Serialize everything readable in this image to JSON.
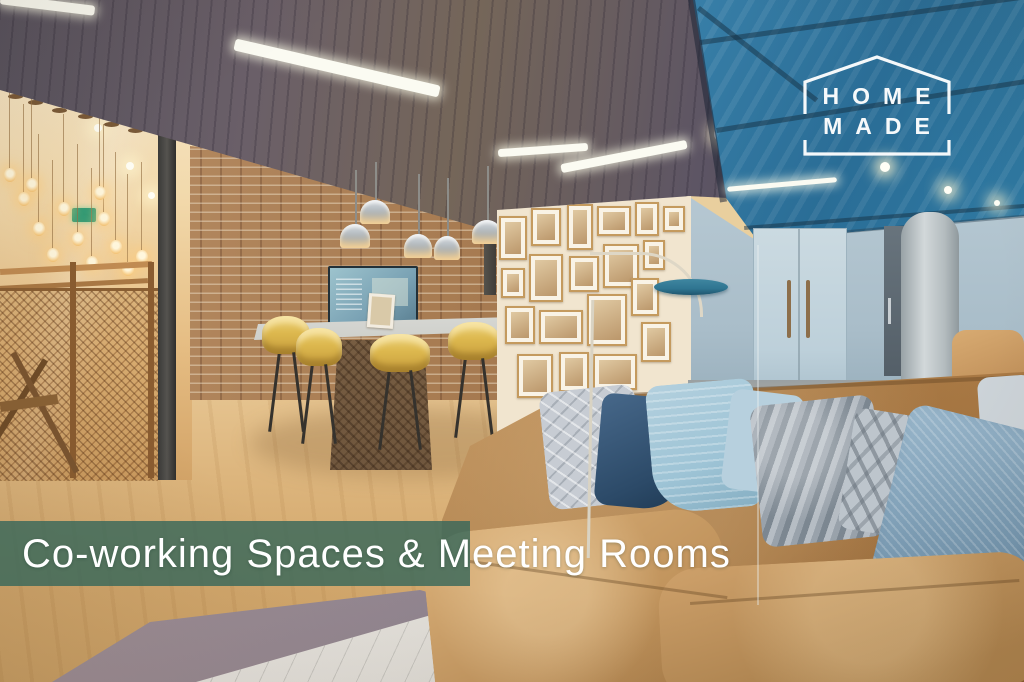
{
  "branding": {
    "logo_line1": "HOME",
    "logo_line2": "MADE",
    "logo_color": "#ffffff"
  },
  "banner": {
    "caption": "Co-working Spaces & Meeting Rooms",
    "text_color": "#ffffff",
    "band_color": "#38685A"
  },
  "scene": {
    "description": "Co-working lounge: vivid blue painted ceiling with dark seams, slate timber ceiling bay, exposed brick wall with wall-mounted TV, white high table with mustard-yellow bar stools, five steel dome pendants, gallery wall of sepia prints in oak frames, pale blue doors and concrete column, teal disc floor lamp, tan suede sofa stacked with blue and grey cushions, pale oak floor, mauve rug with white marble table corner, brass mesh stair screen with festoon bulb chandelier",
    "palette": {
      "ceiling_blue": "#4b94bb",
      "ceiling_dark_bay": "#5e5764",
      "back_ceiling_white": "#f5ead2",
      "brick": "#ab8058",
      "wall_light_blue": "#b7c9d3",
      "door_blue": "#c6d7df",
      "column_grey": "#c2cacc",
      "gallery_wall_cream": "#f1e5cf",
      "frame_oak": "#c49a5e",
      "stool_yellow": "#ddb84e",
      "lamp_teal": "#2f7591",
      "floor_wood": "#dcb57e",
      "rug_mauve": "#9c8e97",
      "marble_white": "#efede8",
      "sofa_tan": "#c3935c",
      "pillow_navy": "#2c4a68",
      "pillow_light_blue": "#9ec4d6",
      "pillow_grey": "#a6adb5",
      "mesh_bronze": "#b5854c",
      "logo_color": "#ffffff",
      "band_color": "#38685A"
    }
  }
}
